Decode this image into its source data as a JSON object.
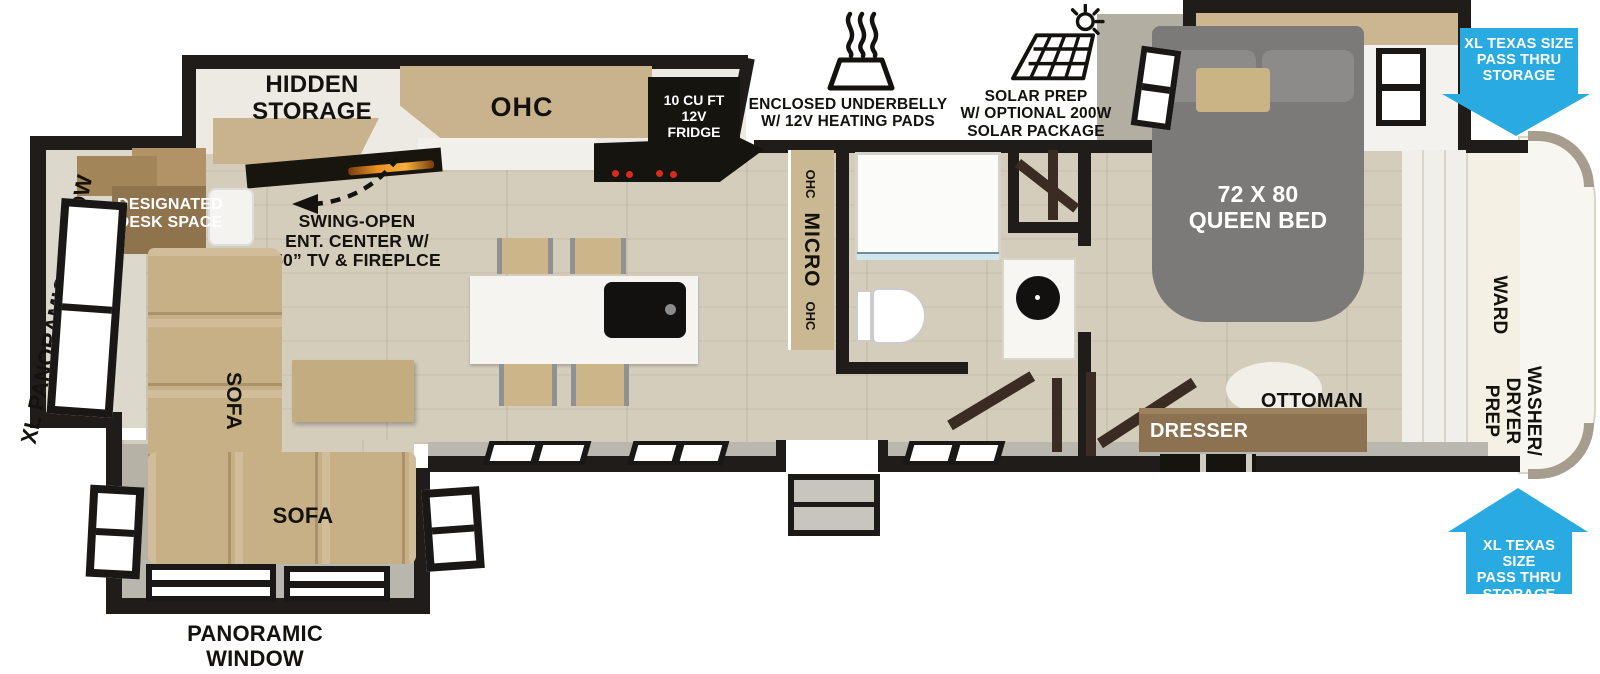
{
  "colors": {
    "wall": "#1f1c19",
    "floor_wood": "#d5cdbc",
    "cabinet_wood": "#c9b38d",
    "sofa_tan": "#c8b086",
    "bed_gray": "#7c7a78",
    "appliance_black": "#16140f",
    "dresser_wood": "#8c7251",
    "door_wood": "#3b2c23",
    "arrow_blue": "#29abe2",
    "burner_red": "#d92b1c"
  },
  "labels": {
    "hidden_storage": "HIDDEN\nSTORAGE",
    "ohc_kitchen": "OHC",
    "fridge": "10 CU FT\n12V\nFRIDGE",
    "underbelly": "ENCLOSED UNDERBELLY\nW/ 12V HEATING PADS",
    "solar": "SOLAR PREP\nW/ OPTIONAL 200W\nSOLAR PACKAGE",
    "pass_thru_top": "XL TEXAS SIZE\nPASS THRU\nSTORAGE",
    "pass_thru_bottom": "XL TEXAS SIZE\nPASS THRU\nSTORAGE",
    "queen_bed": "72 X 80\nQUEEN BED",
    "ward": "WARD",
    "washer_dryer_prep": "WASHER/\nDRYER\nPREP",
    "ottoman": "OTTOMAN",
    "dresser": "DRESSER",
    "micro_top": "OHC",
    "micro_mid": "MICRO",
    "micro_bottom": "OHC",
    "xl_panoramic_window": "XL PANORAMIC WINDOW",
    "designated_desk": "DESIGNATED\nDESK SPACE",
    "swing_open": "SWING-OPEN\nENT. CENTER W/\n50” TV & FIREPLCE",
    "sofa_vertical": "SOFA",
    "sofa_horizontal": "SOFA",
    "panoramic_window": "PANORAMIC\nWINDOW"
  },
  "icons": {
    "heating": "heat-waves-over-underbelly",
    "solar": "solar-panel-with-sun",
    "swing": "dashed-swing-arrow",
    "pass_thru": "blue-directional-arrow"
  }
}
